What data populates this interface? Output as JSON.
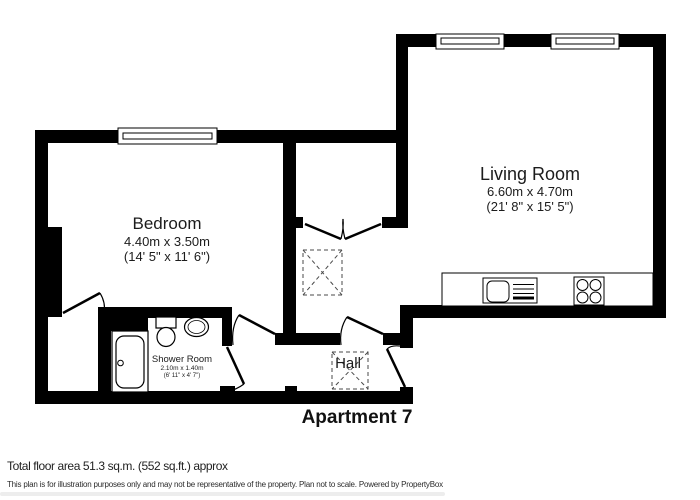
{
  "floorplan": {
    "title": "Apartment 7",
    "rooms": {
      "bedroom": {
        "name": "Bedroom",
        "metric": "4.40m x 3.50m",
        "imperial": "(14' 5\" x 11' 6\")"
      },
      "living_room": {
        "name": "Living Room",
        "metric": "6.60m x 4.70m",
        "imperial": "(21' 8\" x 15' 5\")"
      },
      "shower_room": {
        "name": "Shower Room",
        "metric": "2.10m x 1.40m",
        "imperial": "(6' 11\" x 4' 7\")"
      },
      "hall": {
        "name": "Hall"
      }
    },
    "footer": {
      "total_area": "Total floor area 51.3 sq.m. (552 sq.ft.) approx",
      "disclaimer": "This plan is for illustration purposes only and may not be representative of the property. Plan not to scale. Powered by PropertyBox"
    },
    "colors": {
      "wall": "#000000",
      "text": "#1c1c1c",
      "background": "#ffffff"
    }
  }
}
